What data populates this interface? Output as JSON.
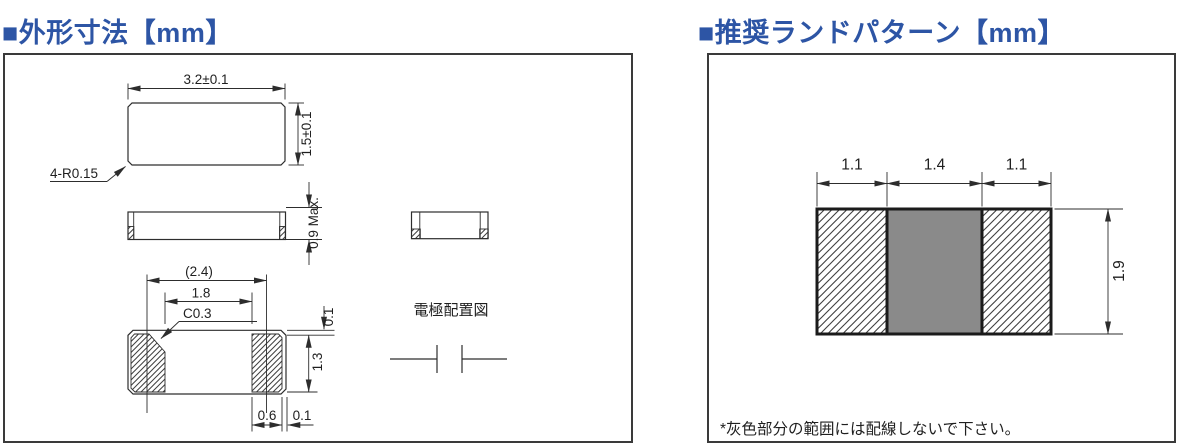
{
  "accent_color": "#2d55a5",
  "line_color": "#2d2d2d",
  "left_panel": {
    "title": "■外形寸法【mm】",
    "top_view": {
      "dim_width": "3.2±0.1",
      "dim_height": "1.5±0.1",
      "corner_label": "4-R0.15"
    },
    "side_view": {
      "dim_thickness": "0.9 Max."
    },
    "bottom_view": {
      "dim_pad_center_pitch": "(2.4)",
      "dim_pad_inner_gap": "1.8",
      "chamfer_label": "C0.3",
      "dim_top_margin": "0.1",
      "dim_pad_depth": "1.3",
      "dim_pad_width": "0.6",
      "dim_side_margin": "0.1"
    },
    "electrode_diagram_label": "電極配置図"
  },
  "right_panel": {
    "title": "■推奨ランドパターン【mm】",
    "land_pattern": {
      "dim_left_pad_width": "1.1",
      "dim_center_width": "1.4",
      "dim_right_pad_width": "1.1",
      "dim_height": "1.9",
      "keepout_color": "#8a8a8a"
    },
    "note": "*灰色部分の範囲には配線しないで下さい。"
  }
}
